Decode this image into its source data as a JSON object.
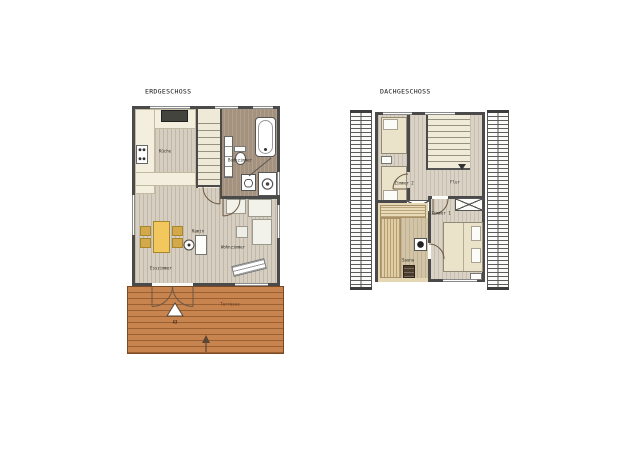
{
  "erdgeschoss": {
    "title": "ERDGESCHOSS",
    "rooms": {
      "kueche": "Küche",
      "badezimmer": "Badezimmer",
      "kamin": "Kamin",
      "wohnzimmer": "Wohnzimmer",
      "esszimmer": "Esszimmer"
    },
    "terrace": {
      "label": "Terrasse",
      "marker": "A3"
    }
  },
  "dachgeschoss": {
    "title": "DACHGESCHOSS",
    "rooms": {
      "zimmer2": "Zimmer 2",
      "flur": "Flur",
      "zimmer1": "Zimmer 1",
      "sauna": "Sauna"
    }
  },
  "colors": {
    "wall": "#4a4a4a",
    "floor_wood": "#d6cfc1",
    "bathroom_floor": "#a5927e",
    "counter_cream": "#f3eedd",
    "terrace_wood": "#c8844f",
    "dining_table_yellow": "#f2c75e",
    "chair_yellow": "#d4a94a",
    "sauna_wood": "#e5d7b3",
    "bed_cream": "#eae2c9"
  }
}
